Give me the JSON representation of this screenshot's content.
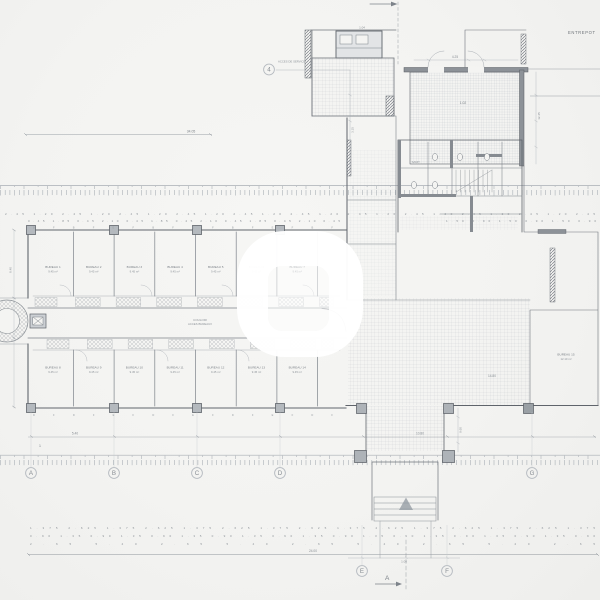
{
  "drawing": {
    "annotations": {
      "entrepot": "ENTREPOT",
      "top_dim": "34.05",
      "service_note": "ACCES DE SERVICE",
      "upper_room": "1.04",
      "room_code": "1.02",
      "sanit": "SANIT.",
      "hall_area": "14.80",
      "corridor": "COULOIR",
      "corridor_sub": "ACCES BUREAUX",
      "dim_a": "5.40",
      "dim_b": "10.80",
      "dim_c": "24.00",
      "dim_left": "8.40",
      "dim_right": "12.45",
      "dim_top_right": "4.25",
      "dim_v4": "3.15",
      "dim_stair": "9.60",
      "dim_ef": "1.00",
      "tick_one": "1",
      "section_label": "A"
    },
    "bubbles": {
      "b4": "4",
      "bA": "A",
      "bB": "B",
      "bC": "C",
      "bD": "D",
      "bG": "G",
      "bE": "E",
      "bF": "F"
    },
    "rooms_top": [
      {
        "name": "BUREAU 1",
        "area": "9.45 m²"
      },
      {
        "name": "BUREAU 2",
        "area": "9.45 m²"
      },
      {
        "name": "BUREAU 3",
        "area": "9.45 m²"
      },
      {
        "name": "BUREAU 4",
        "area": "9.45 m²"
      },
      {
        "name": "BUREAU 5",
        "area": "9.45 m²"
      },
      {
        "name": "BUREAU 6",
        "area": "9.45 m²"
      },
      {
        "name": "BUREAU 7",
        "area": "9.45 m²"
      }
    ],
    "rooms_bottom": [
      {
        "name": "BUREAU 8",
        "area": "9.45 m²"
      },
      {
        "name": "BUREAU 9",
        "area": "9.45 m²"
      },
      {
        "name": "BUREAU 10",
        "area": "9.45 m²"
      },
      {
        "name": "BUREAU 11",
        "area": "9.45 m²"
      },
      {
        "name": "BUREAU 12",
        "area": "9.45 m²"
      },
      {
        "name": "BUREAU 13",
        "area": "9.45 m²"
      },
      {
        "name": "BUREAU 14",
        "area": "9.45 m²"
      }
    ],
    "room_right": {
      "name": "BUREAU 15",
      "area": "12.10 m²"
    },
    "dim_rows": {
      "top": "2.45 1.20 2.45 1.20 2.45 1.20 2.45 1.20 2.45 1.20 2.45 1.20 2.45 1.20 2.45 1.20 2.45 1.20 2.45 1.20 2.45",
      "top2": "0.45 1.85 0.45 2.10 0.45 1.85 0.45 2.10 0.45 1.85 0.45 2.10 0.45",
      "top3": "1.50 0.90 1.50 0.90 1.50 0.90",
      "bottom1": "1.375 2.625 1.375 2.625 1.375 2.625 1.375 2.625 1.375 2.625 1.375 2.625 1.375 2.625 1.375",
      "bottom2": "0.90 1.35 0.90 1.35 0.90 1.35 0.90 1.35 0.90 1.35 0.90 1.35 0.90 1.35 0.90 1.35 0.90 1.35 0.90",
      "bottom3": "2.65 5.40 2.65 5.40 2.65 5.40 2.65 5.40 2.65",
      "top_tags": "B F B F E F B F E F B F E F B F",
      "bottom_tags": "D F D F E F D F E F D F E F D F"
    }
  }
}
